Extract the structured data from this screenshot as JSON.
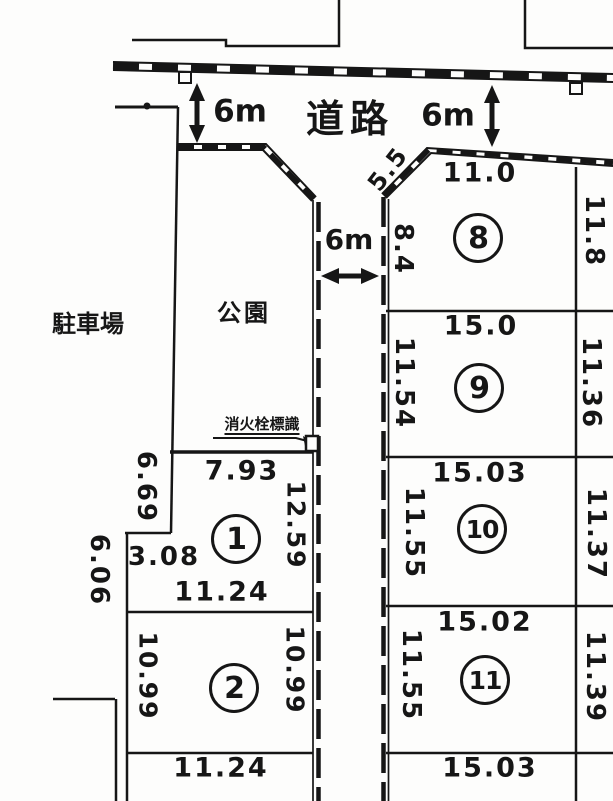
{
  "colors": {
    "ink": "#161616",
    "paper": "#fdfdfc"
  },
  "areas": {
    "road": "道路",
    "parking": "駐車場",
    "park": "公園"
  },
  "road_widths": {
    "top_left": "6m",
    "top_right": "6m",
    "middle": "6m"
  },
  "fire_hydrant": {
    "label": "消火栓標識"
  },
  "outer": {
    "parking_edge": "6.06"
  },
  "plots": {
    "p1": {
      "number": "1",
      "top": "7.93",
      "right": "12.59",
      "left": "6.69",
      "step": "3.08",
      "bottom": "11.24"
    },
    "p2": {
      "number": "2",
      "left": "10.99",
      "right": "10.99",
      "bottom": "11.24"
    },
    "p8": {
      "number": "8",
      "corner": "5.5",
      "top": "11.0",
      "left": "8.4",
      "right": "11.8"
    },
    "p9": {
      "number": "9",
      "top": "15.0",
      "left": "11.54",
      "right": "11.36"
    },
    "p10": {
      "number": "10",
      "top": "15.03",
      "left": "11.55",
      "right": "11.37"
    },
    "p11": {
      "number": "11",
      "top": "15.02",
      "left": "11.55",
      "right": "11.39",
      "bottom": "15.03"
    }
  }
}
